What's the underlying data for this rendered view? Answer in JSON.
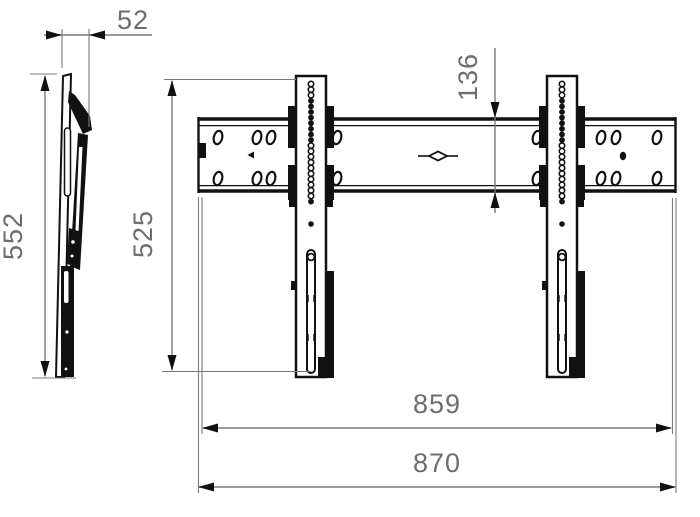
{
  "drawing": {
    "colors": {
      "outline": "#111111",
      "dimension_line": "#7a7a7a",
      "dimension_text": "#6d6d6d",
      "background": "#ffffff"
    },
    "side_view": {
      "depth_label": "52",
      "height_label": "552"
    },
    "front_view": {
      "bracket_height_label": "525",
      "rail_height_label": "136",
      "inner_width_label": "859",
      "overall_width_label": "870"
    }
  }
}
